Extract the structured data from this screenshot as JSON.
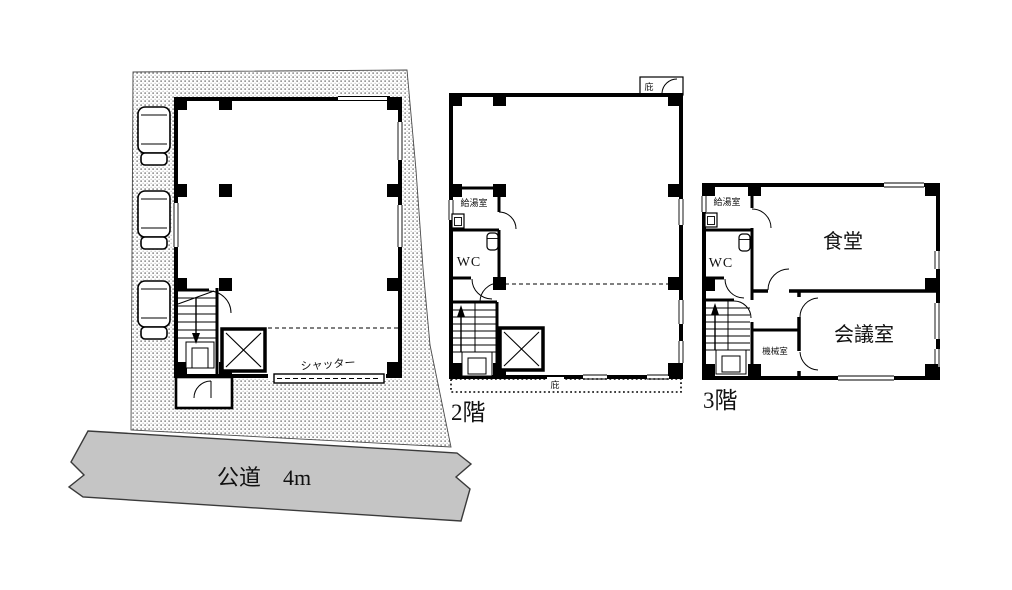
{
  "site": {
    "road_label": "公道　4m",
    "shutter_label": "シャッター"
  },
  "floor2": {
    "floor_label": "2階",
    "kitchenette_label": "給湯室",
    "wc_label": "WC",
    "canopy_top_label": "庇",
    "canopy_bottom_label": "庇"
  },
  "floor3": {
    "floor_label": "3階",
    "kitchenette_label": "給湯室",
    "wc_label": "WC",
    "dining_label": "食堂",
    "meeting_label": "会議室",
    "machine_label": "機械室"
  },
  "colors": {
    "line": "#111111",
    "road_fill": "#c5c5c5",
    "paper": "#ffffff"
  }
}
